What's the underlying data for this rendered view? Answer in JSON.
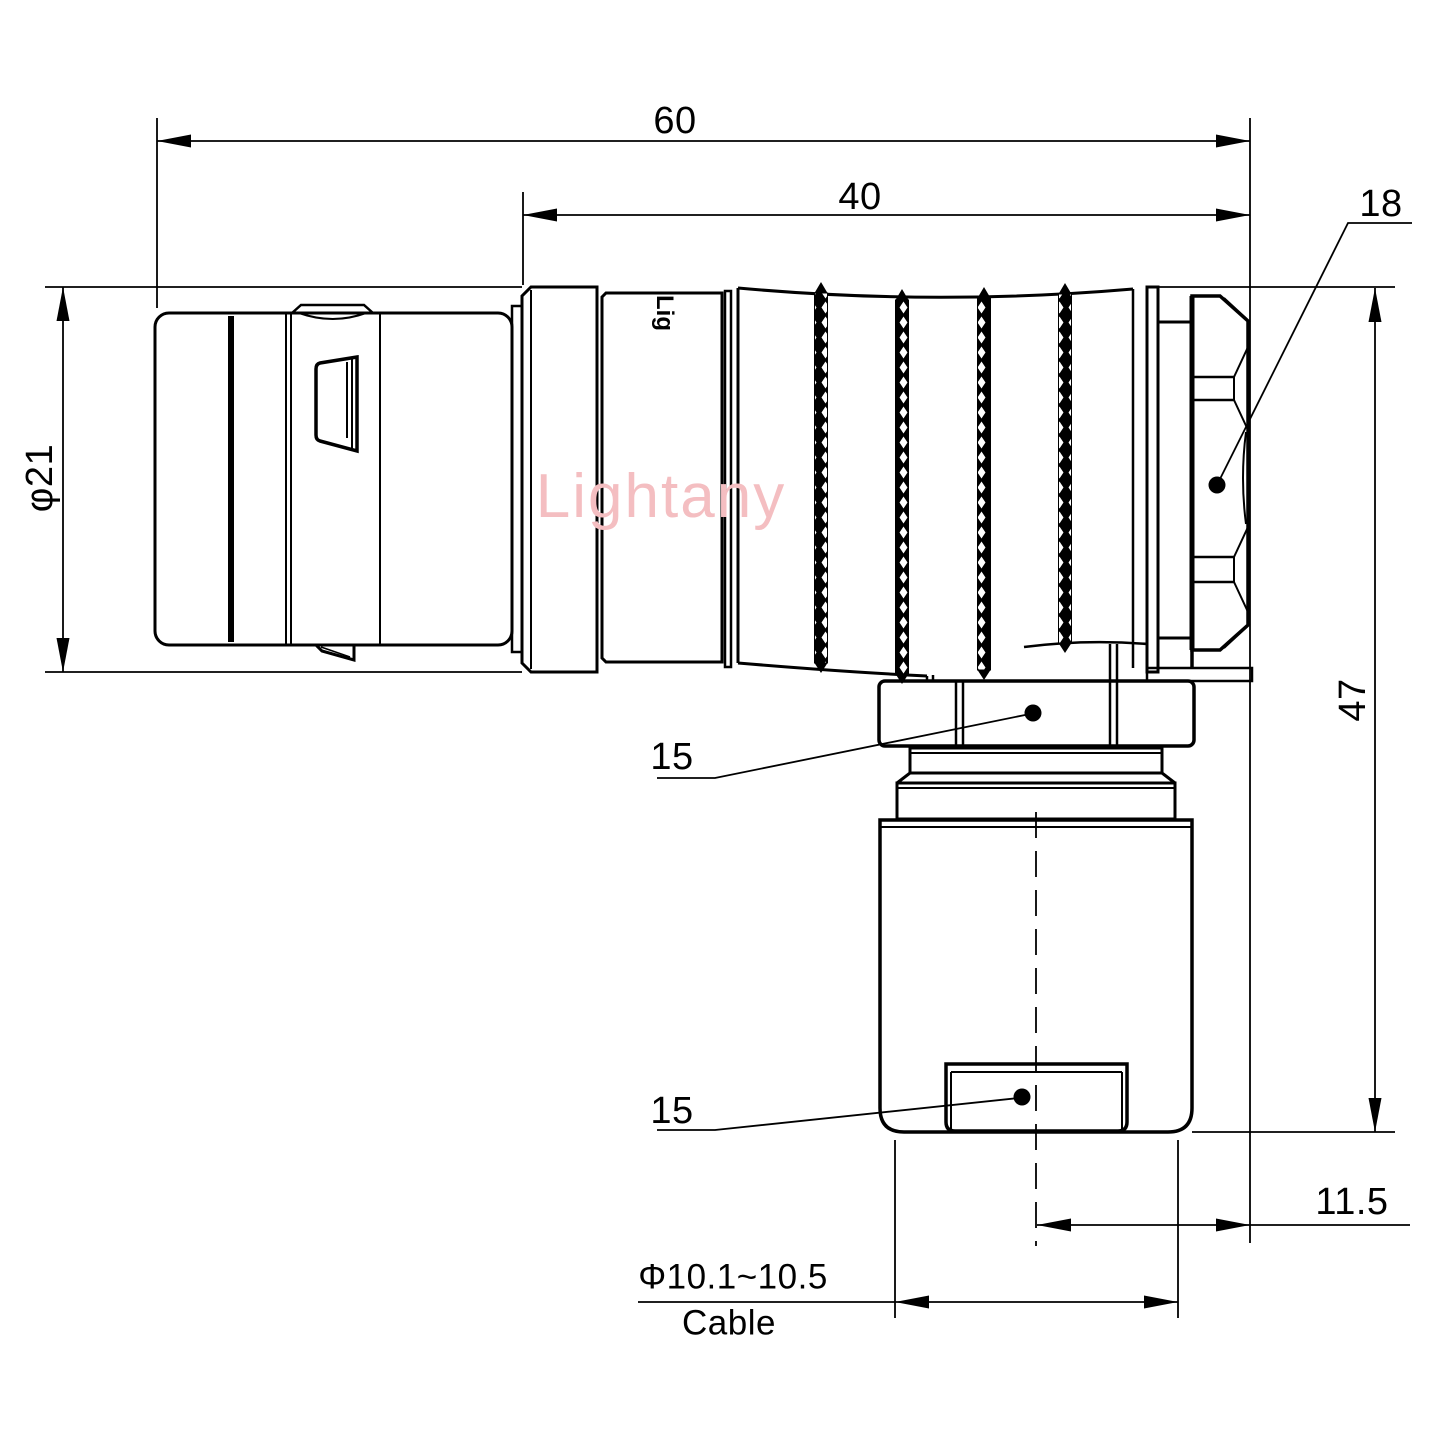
{
  "drawing": {
    "watermark": "Lightany",
    "brand_mark": "Lig",
    "labels": {
      "dim60": "60",
      "dim40": "40",
      "dim18": "18",
      "dia21": "φ21",
      "dim47": "47",
      "dim15_upper": "15",
      "dim15_lower": "15",
      "dim115": "11.5",
      "cable_dia": "Φ10.1~10.5",
      "cable": "Cable"
    },
    "colors": {
      "line": "#000000",
      "background": "#ffffff",
      "watermark": "#f4bec1"
    }
  }
}
